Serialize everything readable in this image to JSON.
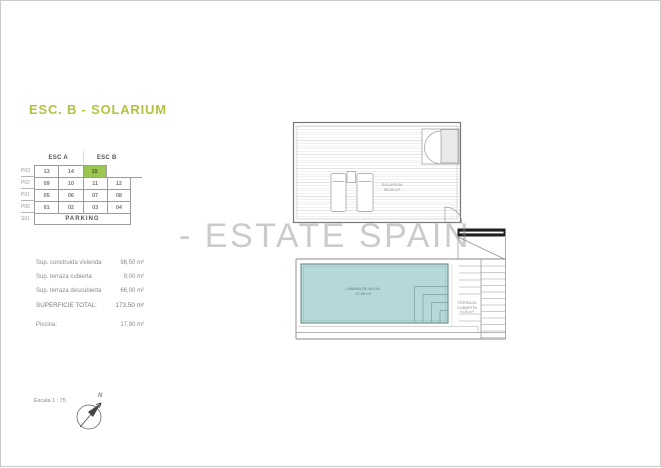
{
  "page": {
    "title": "ESC. B - SOLARIUM",
    "watermark": "- ESTATE SPAIN",
    "scale_label": "Escala 1 : 75",
    "compass_n": "N"
  },
  "table": {
    "col_headers": [
      "ESC A",
      "ESC B"
    ],
    "rows": [
      {
        "label": "P03",
        "cells": [
          "13",
          "14",
          "15"
        ],
        "highlight_index": 2
      },
      {
        "label": "P02",
        "cells": [
          "09",
          "10",
          "11",
          "12"
        ]
      },
      {
        "label": "P01",
        "cells": [
          "05",
          "06",
          "07",
          "08"
        ]
      },
      {
        "label": "P00",
        "cells": [
          "01",
          "02",
          "03",
          "04"
        ]
      },
      {
        "label": "S01",
        "parking": "PARKING"
      }
    ]
  },
  "surfaces": {
    "items": [
      {
        "label": "Sup. construida vivienda",
        "value": "98,50 m²"
      },
      {
        "label": "Sup. terraza cubierta",
        "value": "9,00 m²"
      },
      {
        "label": "Sup. terraza descubierta",
        "value": "66,00 m²"
      },
      {
        "label": "SUPERFICIE TOTAL:",
        "value": "173,50 m²",
        "total": true
      },
      {
        "label": "Piscina:",
        "value": "17,90 m²",
        "gap": true
      }
    ]
  },
  "plan": {
    "room_label": "SOLARIUM",
    "room_area": "66,00 m²",
    "pool_label": "LAMINA DE AGUA",
    "pool_area": "17,90 m²",
    "terrace_label": "TERRAZA CUBIERTA",
    "terrace_area": "9,00 m²"
  },
  "colors": {
    "accent": "#b4c13e",
    "highlight": "#9cc653",
    "pool": "#b5d9d8",
    "watermark": "#c6c6c6"
  }
}
